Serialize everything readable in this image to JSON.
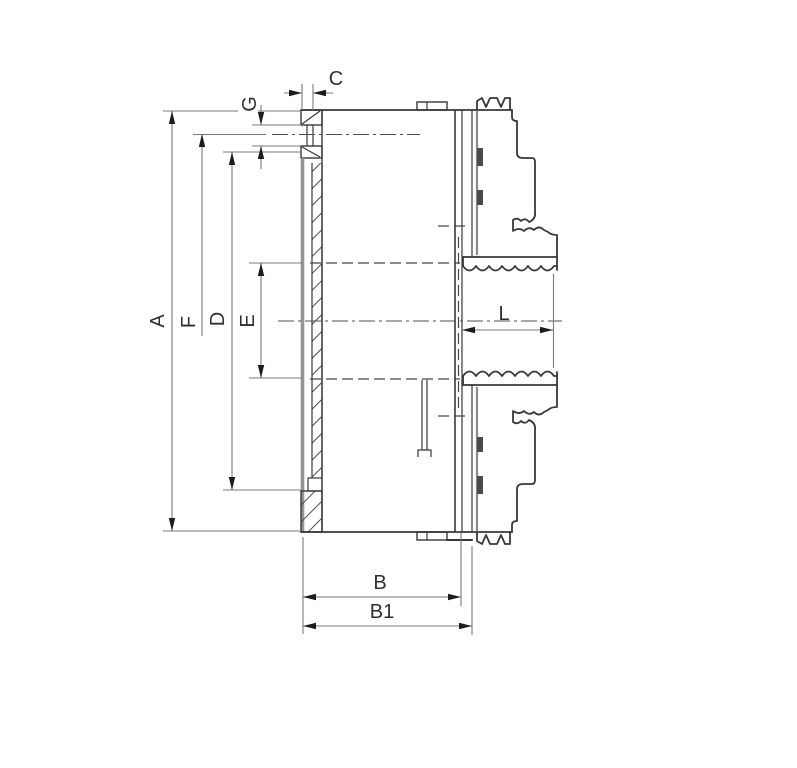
{
  "drawing": {
    "dimension_labels": {
      "a": "A",
      "f": "F",
      "d": "D",
      "e": "E",
      "g": "G",
      "c": "C",
      "l": "L",
      "b": "B",
      "b1": "B1"
    },
    "colors": {
      "outline": "#383838",
      "dimension_lines": "#7a7a7a",
      "arrowheads": "#1c1c1c",
      "section_face": "#949494",
      "label_text": "#2f2f2f",
      "background": "#ffffff"
    }
  }
}
